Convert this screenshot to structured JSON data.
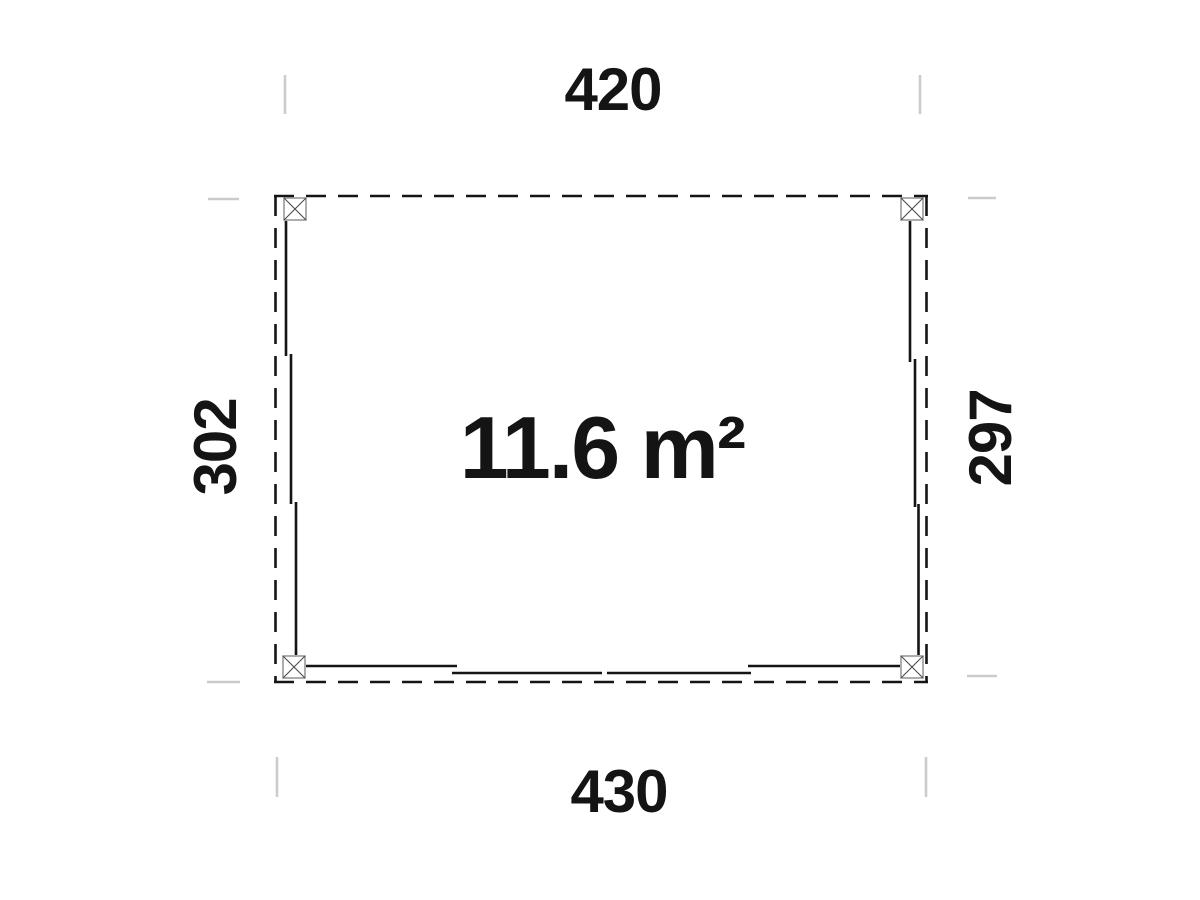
{
  "diagram": {
    "type": "floor-plan",
    "area_label": "11.6 m²",
    "dimensions": {
      "top": "420",
      "bottom": "430",
      "left": "302",
      "right": "297"
    }
  },
  "colors": {
    "background": "#ffffff",
    "line": "#141414",
    "post_outline": "#8a8a8a",
    "post_cross": "#4a4a4a",
    "extent_tick": "#cbcbcb",
    "text": "#141414"
  }
}
